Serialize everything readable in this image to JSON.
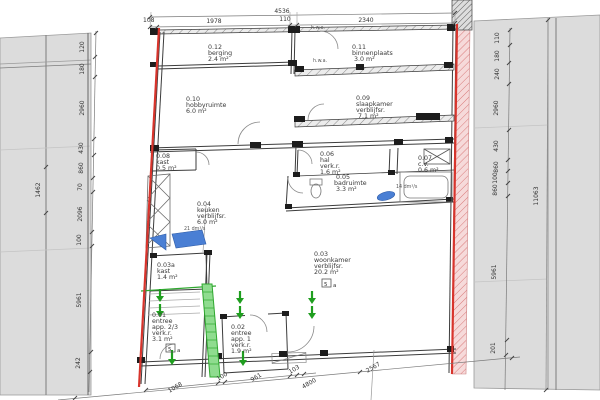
{
  "title": "floor-plan-ground-floor",
  "colors": {
    "red": "#d8342c",
    "green": "#2fa82f",
    "blue": "#4a7fd4",
    "gray": "#dcdcdc"
  },
  "rooms": [
    {
      "id": "0.12",
      "name": "berging",
      "area": "2.4 m²"
    },
    {
      "id": "0.11",
      "name": "binnenplaats",
      "area": "3.0 m²"
    },
    {
      "id": "0.10",
      "name": "hobbyruimte",
      "area": "6.0 m²"
    },
    {
      "id": "0.09",
      "name": "slaapkamer",
      "extra": "verblijfsr.",
      "area": "7.1 m²"
    },
    {
      "id": "0.08",
      "name": "kast",
      "area": "0.5 m²"
    },
    {
      "id": "0.06",
      "name": "hal",
      "extra": "verk.r.",
      "area": "1.6 m²"
    },
    {
      "id": "0.07",
      "name": "c.v.",
      "area": "0.6 m²"
    },
    {
      "id": "0.05",
      "name": "badruimte",
      "area": "3.3 m²"
    },
    {
      "id": "0.04",
      "name": "keuken",
      "extra": "verblijfsr.",
      "area": "6.0 m²"
    },
    {
      "id": "0.03",
      "name": "woonkamer",
      "extra": "verblijfsr.",
      "area": "20.2 m²"
    },
    {
      "id": "0.03a",
      "name": "kast",
      "area": "1.4 m²"
    },
    {
      "id": "0.01",
      "name": "entree",
      "line3": "app. 2/3",
      "extra": "verk.r.",
      "area": "3.1 m²"
    },
    {
      "id": "0.02",
      "name": "entree",
      "line3": "app. 1",
      "extra": "verk.r.",
      "area": "1.9 m²"
    }
  ],
  "dims": {
    "top_overall": "4536",
    "top_segments": [
      "108",
      "1978",
      "110",
      "2340"
    ],
    "left_outer": "1462",
    "left_segments": [
      "120",
      "180",
      "2960",
      "430",
      "860",
      "70",
      "2096",
      "100",
      "5961",
      "242"
    ],
    "right_outer": "11063",
    "right_segments": [
      "110",
      "180",
      "240",
      "2960",
      "430",
      "860",
      "100",
      "860",
      "5961",
      "201"
    ],
    "bottom_segments": [
      "1068",
      "100",
      "961",
      "103"
    ],
    "bottom_lower": [
      "4800",
      "2567"
    ]
  },
  "notes": {
    "hwa": "h.w.a.",
    "vent_bad": "14 dm³/s",
    "vent_keuken": "21 dm³/s",
    "tag_number": "5",
    "tag_letter": "a"
  }
}
